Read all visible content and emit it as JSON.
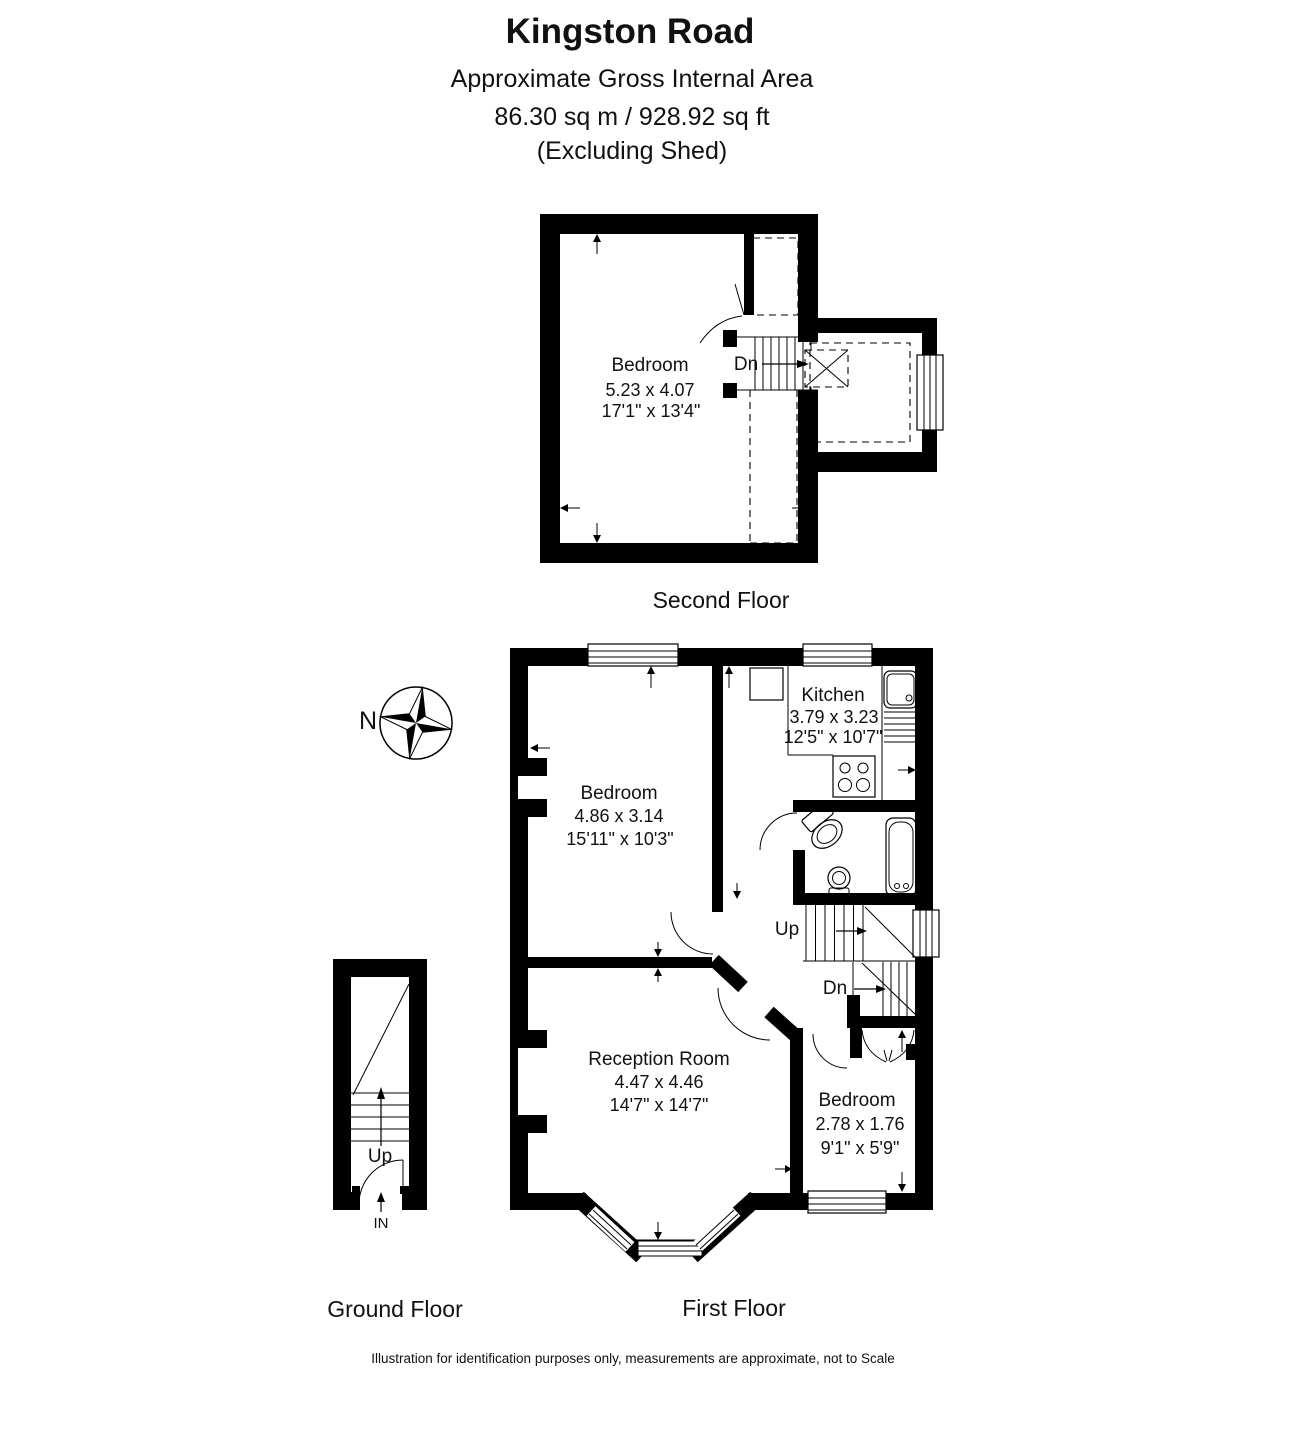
{
  "header": {
    "title": "Kingston Road",
    "subtitle": "Approximate Gross Internal Area",
    "area_line": "86.30 sq m / 928.92 sq ft",
    "exclusion": "(Excluding Shed)"
  },
  "compass": {
    "north_label": "N"
  },
  "floors": {
    "second": {
      "caption": "Second Floor",
      "bedroom": {
        "name": "Bedroom",
        "metric": "5.23 x 4.07",
        "imperial": "17'1\" x 13'4\""
      },
      "down_label": "Dn"
    },
    "first": {
      "caption": "First Floor",
      "kitchen": {
        "name": "Kitchen",
        "metric": "3.79 x 3.23",
        "imperial": "12'5\" x 10'7\""
      },
      "bedroom1": {
        "name": "Bedroom",
        "metric": "4.86 x 3.14",
        "imperial": "15'11\" x 10'3\""
      },
      "reception": {
        "name": "Reception Room",
        "metric": "4.47 x 4.46",
        "imperial": "14'7\" x 14'7\""
      },
      "bedroom2": {
        "name": "Bedroom",
        "metric": "2.78 x 1.76",
        "imperial": "9'1\" x 5'9\""
      },
      "up_label": "Up",
      "down_label": "Dn"
    },
    "ground": {
      "caption": "Ground Floor",
      "up_label": "Up",
      "entrance_label": "IN"
    }
  },
  "footer": {
    "disclaimer": "Illustration for identification purposes only, measurements are approximate, not to Scale"
  },
  "colors": {
    "wall": "#000000",
    "line": "#111111",
    "background": "#ffffff"
  }
}
